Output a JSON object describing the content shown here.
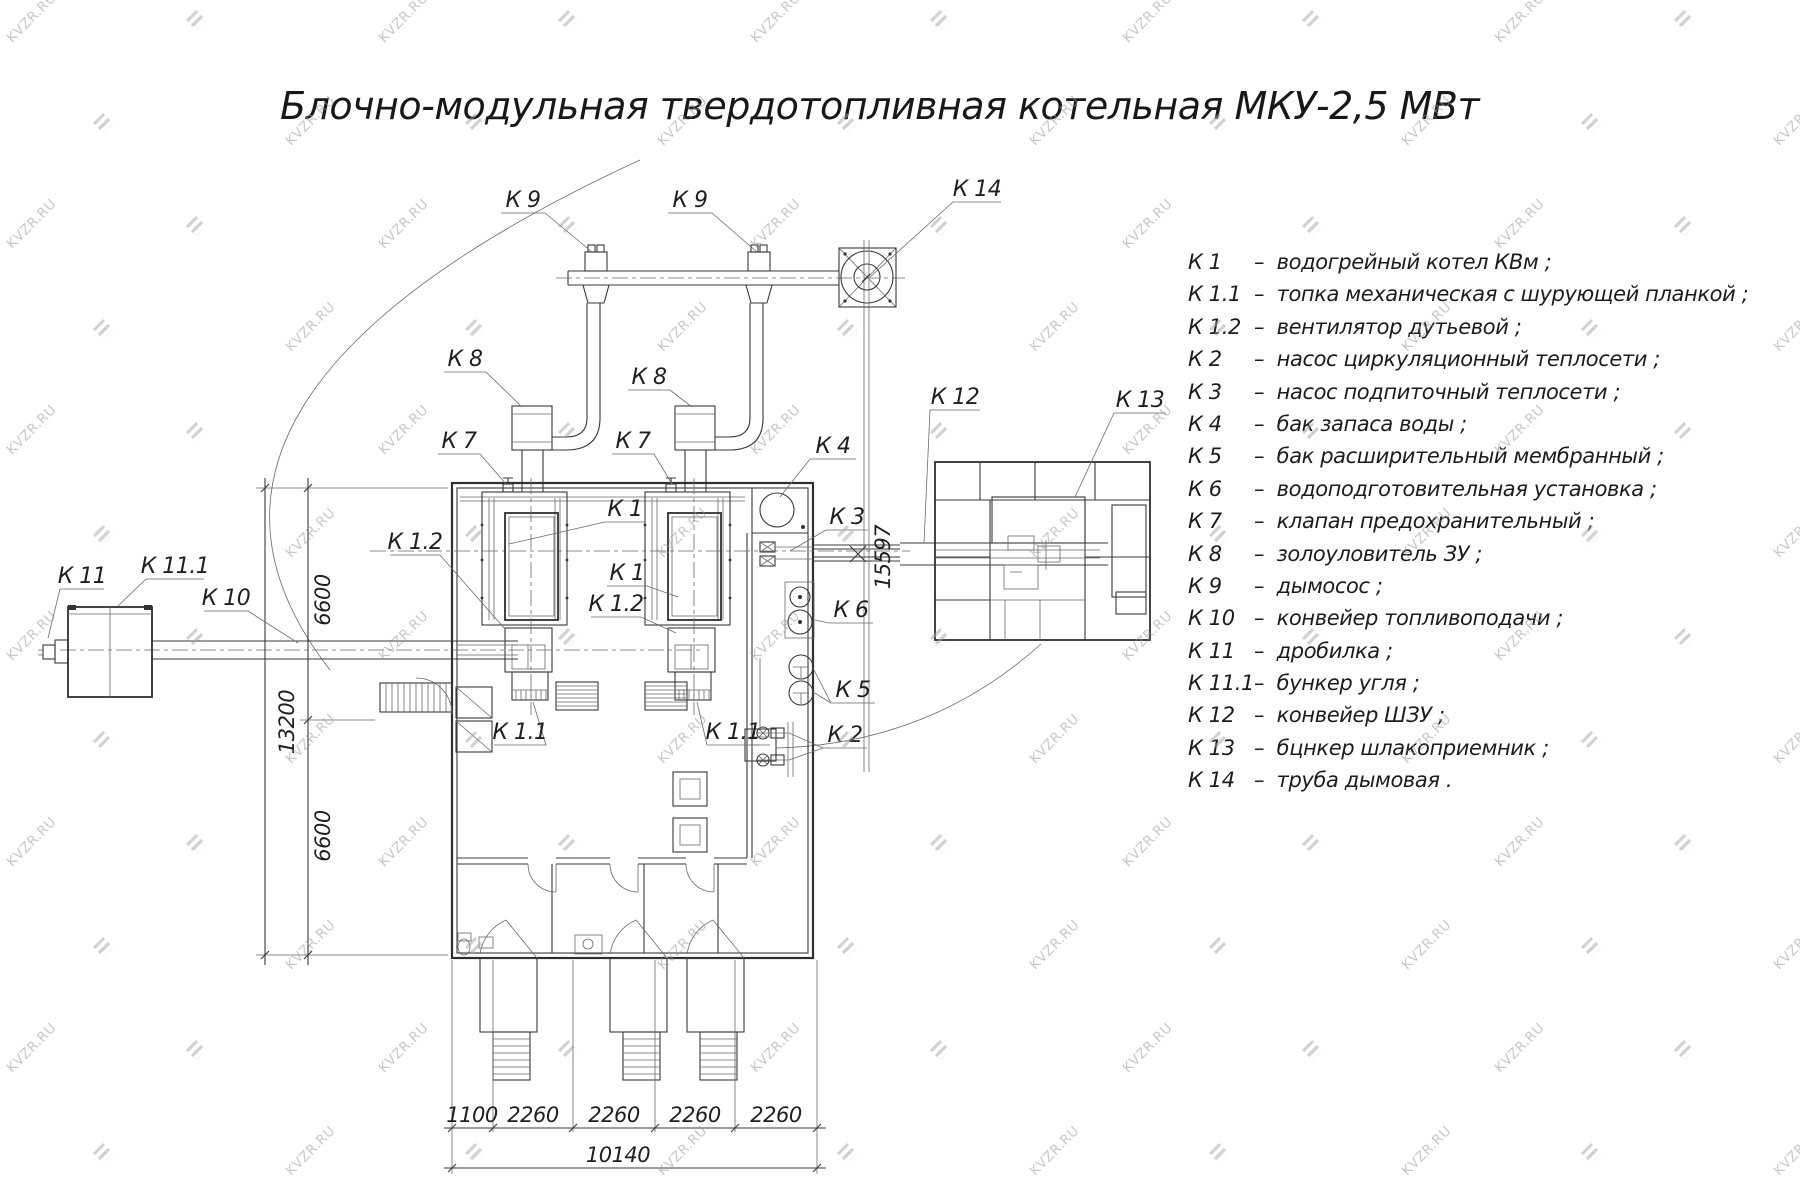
{
  "title": "Блочно-модульная твердотопливная котельная МКУ-2,5 МВт",
  "watermark": {
    "text": "KVZR.RU"
  },
  "legend": {
    "items": [
      {
        "code": "К 1",
        "text": "–  водогрейный котел КВм ;"
      },
      {
        "code": "К 1.1",
        "text": "–  топка механическая с шурующей планкой ;"
      },
      {
        "code": "К 1.2",
        "text": "–  вентилятор дутьевой ;"
      },
      {
        "code": "К 2",
        "text": "–  насос циркуляционный теплосети ;"
      },
      {
        "code": "К 3",
        "text": "–  насос подпиточный теплосети ;"
      },
      {
        "code": "К 4",
        "text": "–  бак запаса воды ;"
      },
      {
        "code": "К 5",
        "text": "–  бак расширительный мембранный ;"
      },
      {
        "code": "К 6",
        "text": "–  водоподготовительная установка ;"
      },
      {
        "code": "К 7",
        "text": "–  клапан предохранительный ;"
      },
      {
        "code": "К 8",
        "text": "–  золоуловитель ЗУ ;"
      },
      {
        "code": "К 9",
        "text": "–  дымосос ;"
      },
      {
        "code": "К 10",
        "text": "–  конвейер топливоподачи ;"
      },
      {
        "code": "К 11",
        "text": "–  дробилка ;"
      },
      {
        "code": "К 11.1",
        "text": "–  бункер угля ;"
      },
      {
        "code": "К 12",
        "text": "–  конвейер ШЗУ ;"
      },
      {
        "code": "К 13",
        "text": "–  бцнкер шлакоприемник ;"
      },
      {
        "code": "К 14",
        "text": "–  труба дымовая ."
      }
    ]
  },
  "drawing": {
    "callouts": [
      {
        "text": "К 9"
      },
      {
        "text": "К 9"
      },
      {
        "text": "К 14"
      },
      {
        "text": "К 8"
      },
      {
        "text": "К 8"
      },
      {
        "text": "К 7"
      },
      {
        "text": "К 7"
      },
      {
        "text": "К 4"
      },
      {
        "text": "К 3"
      },
      {
        "text": "К 12"
      },
      {
        "text": "К 13"
      },
      {
        "text": "К 1"
      },
      {
        "text": "К 1"
      },
      {
        "text": "К 1.2"
      },
      {
        "text": "К 1.2"
      },
      {
        "text": "К 6"
      },
      {
        "text": "К 5"
      },
      {
        "text": "К 2"
      },
      {
        "text": "К 11"
      },
      {
        "text": "К 11.1"
      },
      {
        "text": "К 10"
      },
      {
        "text": "К 1.1"
      },
      {
        "text": "К 1.1"
      }
    ]
  },
  "dimensions": {
    "bottom": [
      "1100",
      "2260",
      "2260",
      "2260",
      "2260"
    ],
    "bottom_total": "10140",
    "left_upper": "6600",
    "left_total": "13200",
    "left_lower": "6600",
    "right_height": "15597"
  }
}
